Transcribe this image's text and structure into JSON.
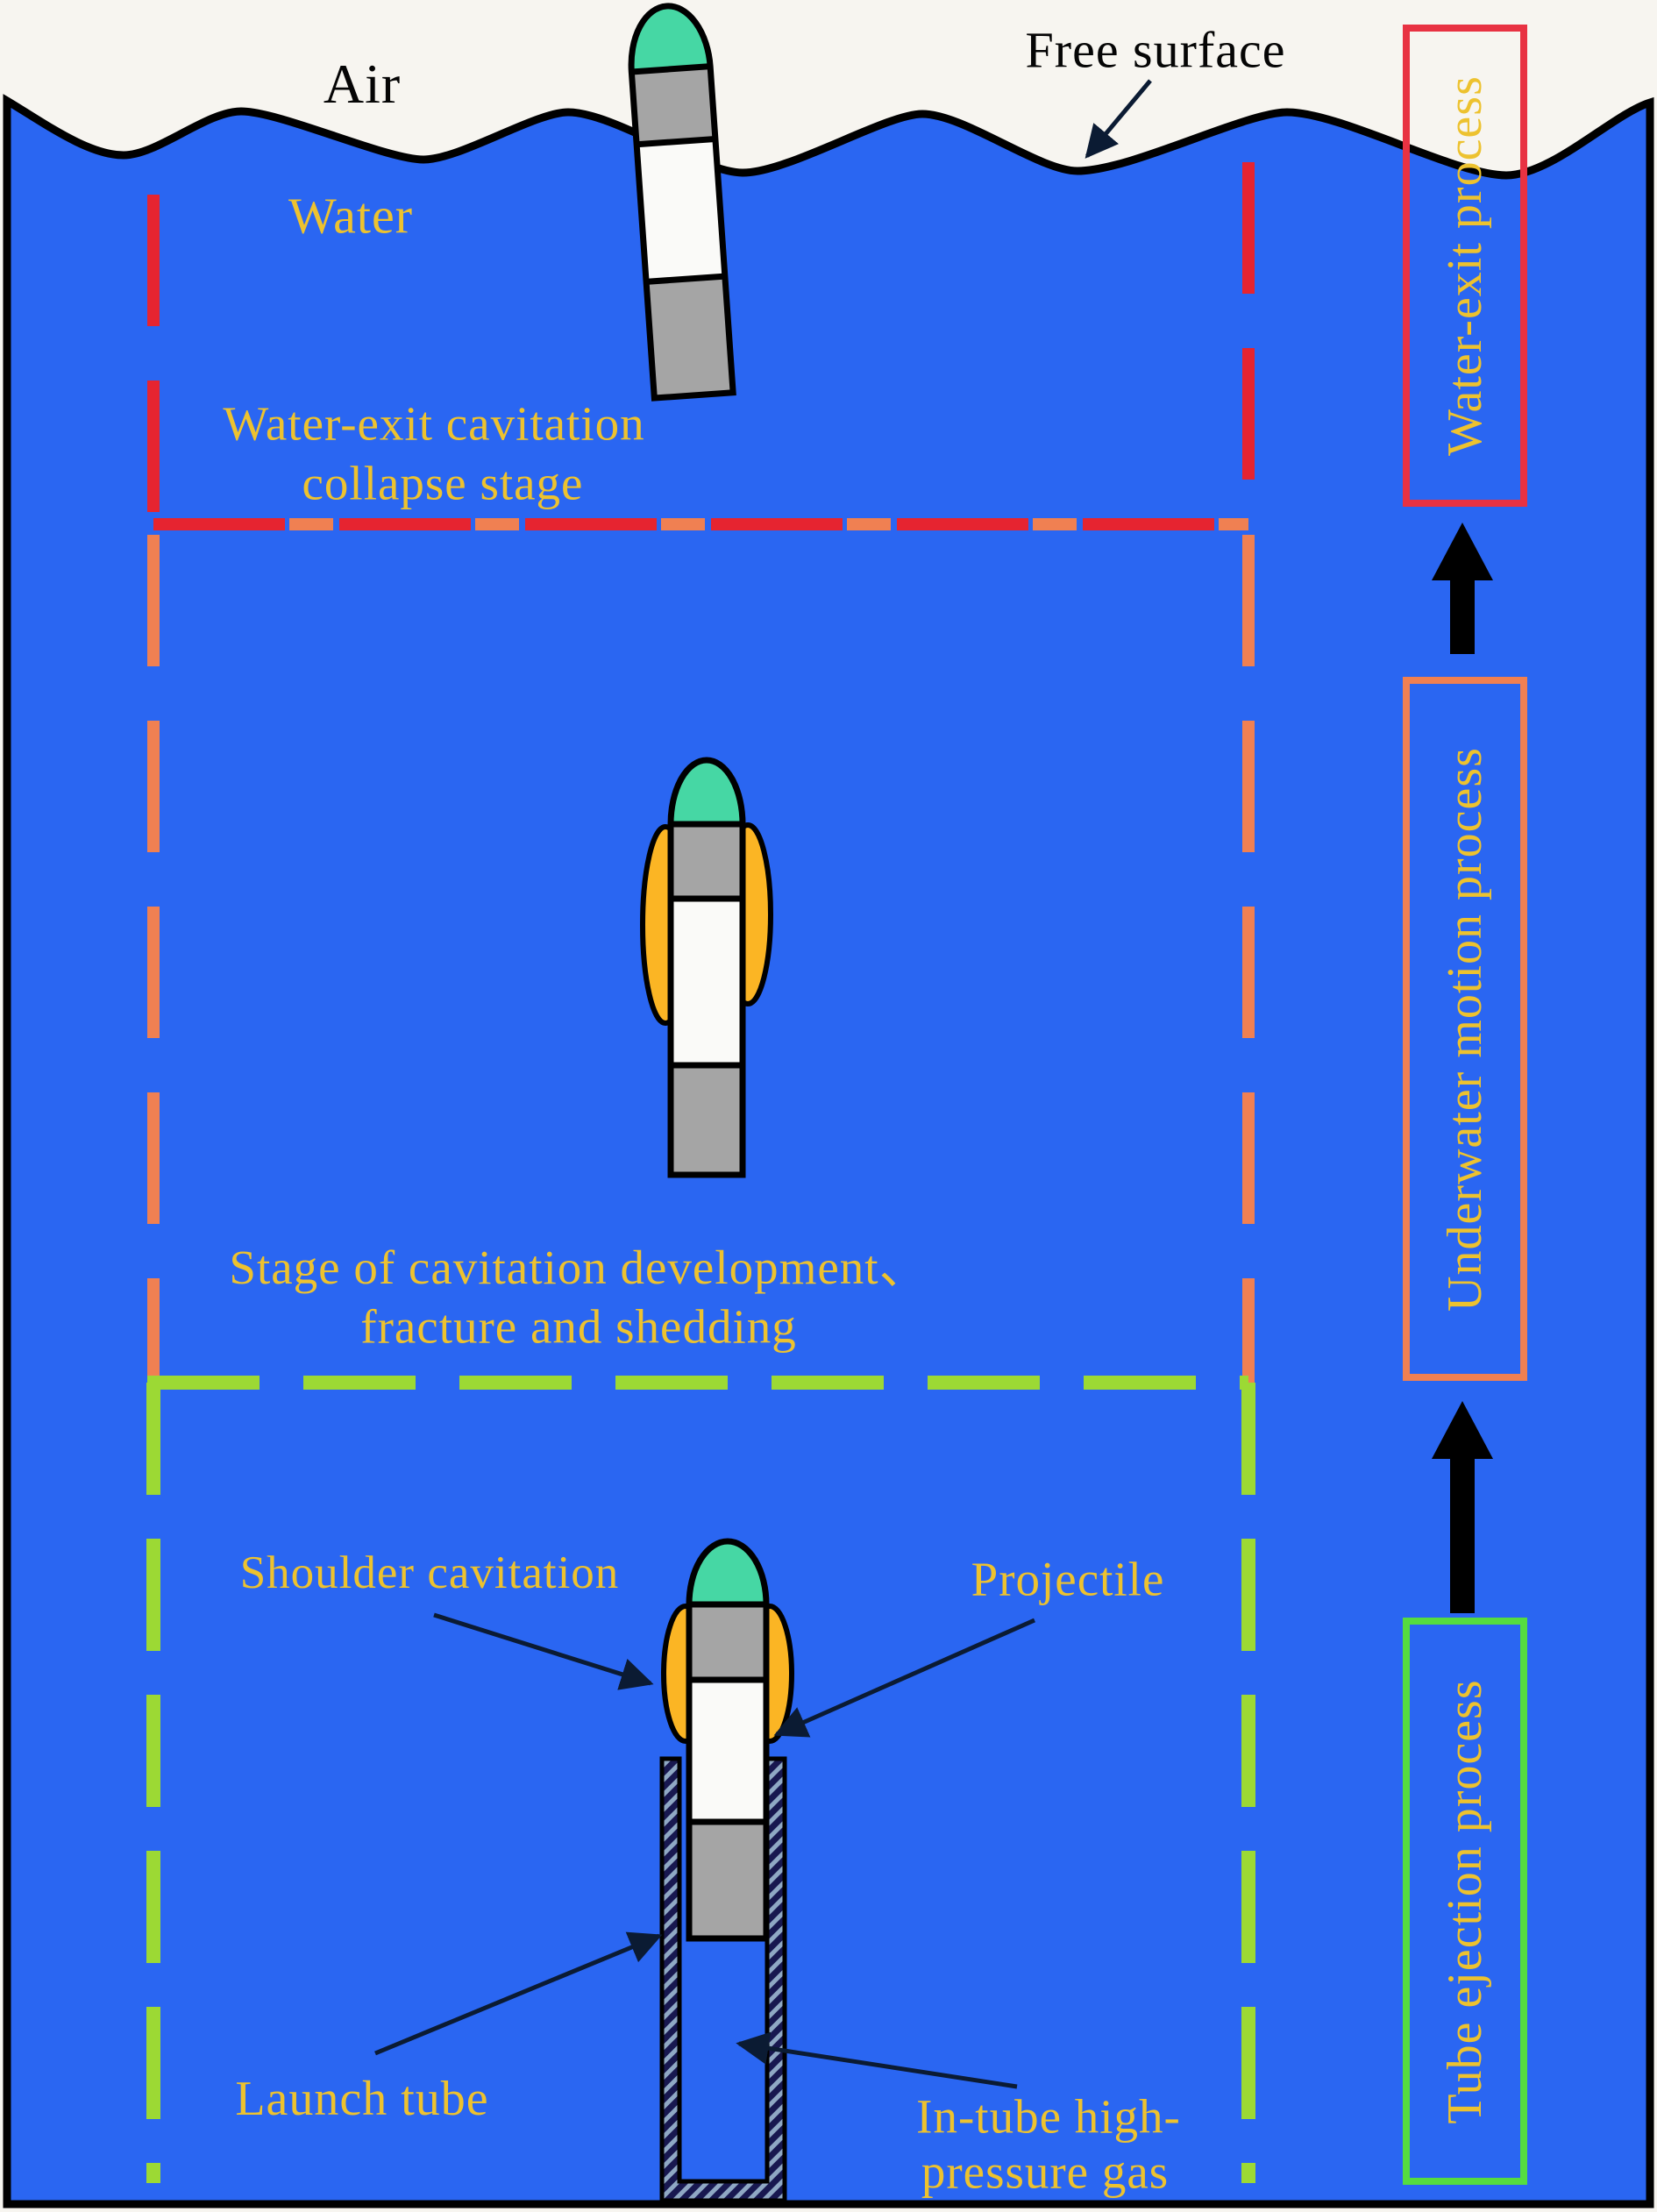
{
  "labels": {
    "air": "Air",
    "free_surface": "Free surface",
    "water": "Water",
    "stage_collapse_line1": "Water-exit cavitation",
    "stage_collapse_line2": "collapse stage",
    "stage_development_line1": "Stage of cavitation development、",
    "stage_development_line2": "fracture and shedding",
    "shoulder_cavitation": "Shoulder cavitation",
    "projectile": "Projectile",
    "launch_tube": "Launch tube",
    "intube_line1": "In-tube high-",
    "intube_line2": "pressure gas"
  },
  "process_flow": {
    "water_exit": "Water-exit process",
    "underwater_motion": "Underwater motion process",
    "tube_ejection": "Tube ejection process"
  },
  "colors": {
    "water_blue": "#2A66F2",
    "air_white": "#F7F5F0",
    "label_yellow": "#EDC22F",
    "stage1_red": "#E62430",
    "stage2_orange": "#F08052",
    "stage3_green": "#9CD934",
    "box_red": "#E83242",
    "box_orange": "#F08052",
    "box_green": "#55DC40",
    "nose_teal": "#46D7A4",
    "body_gray": "#A5A5A5",
    "cavitation_amber": "#FBB524"
  }
}
